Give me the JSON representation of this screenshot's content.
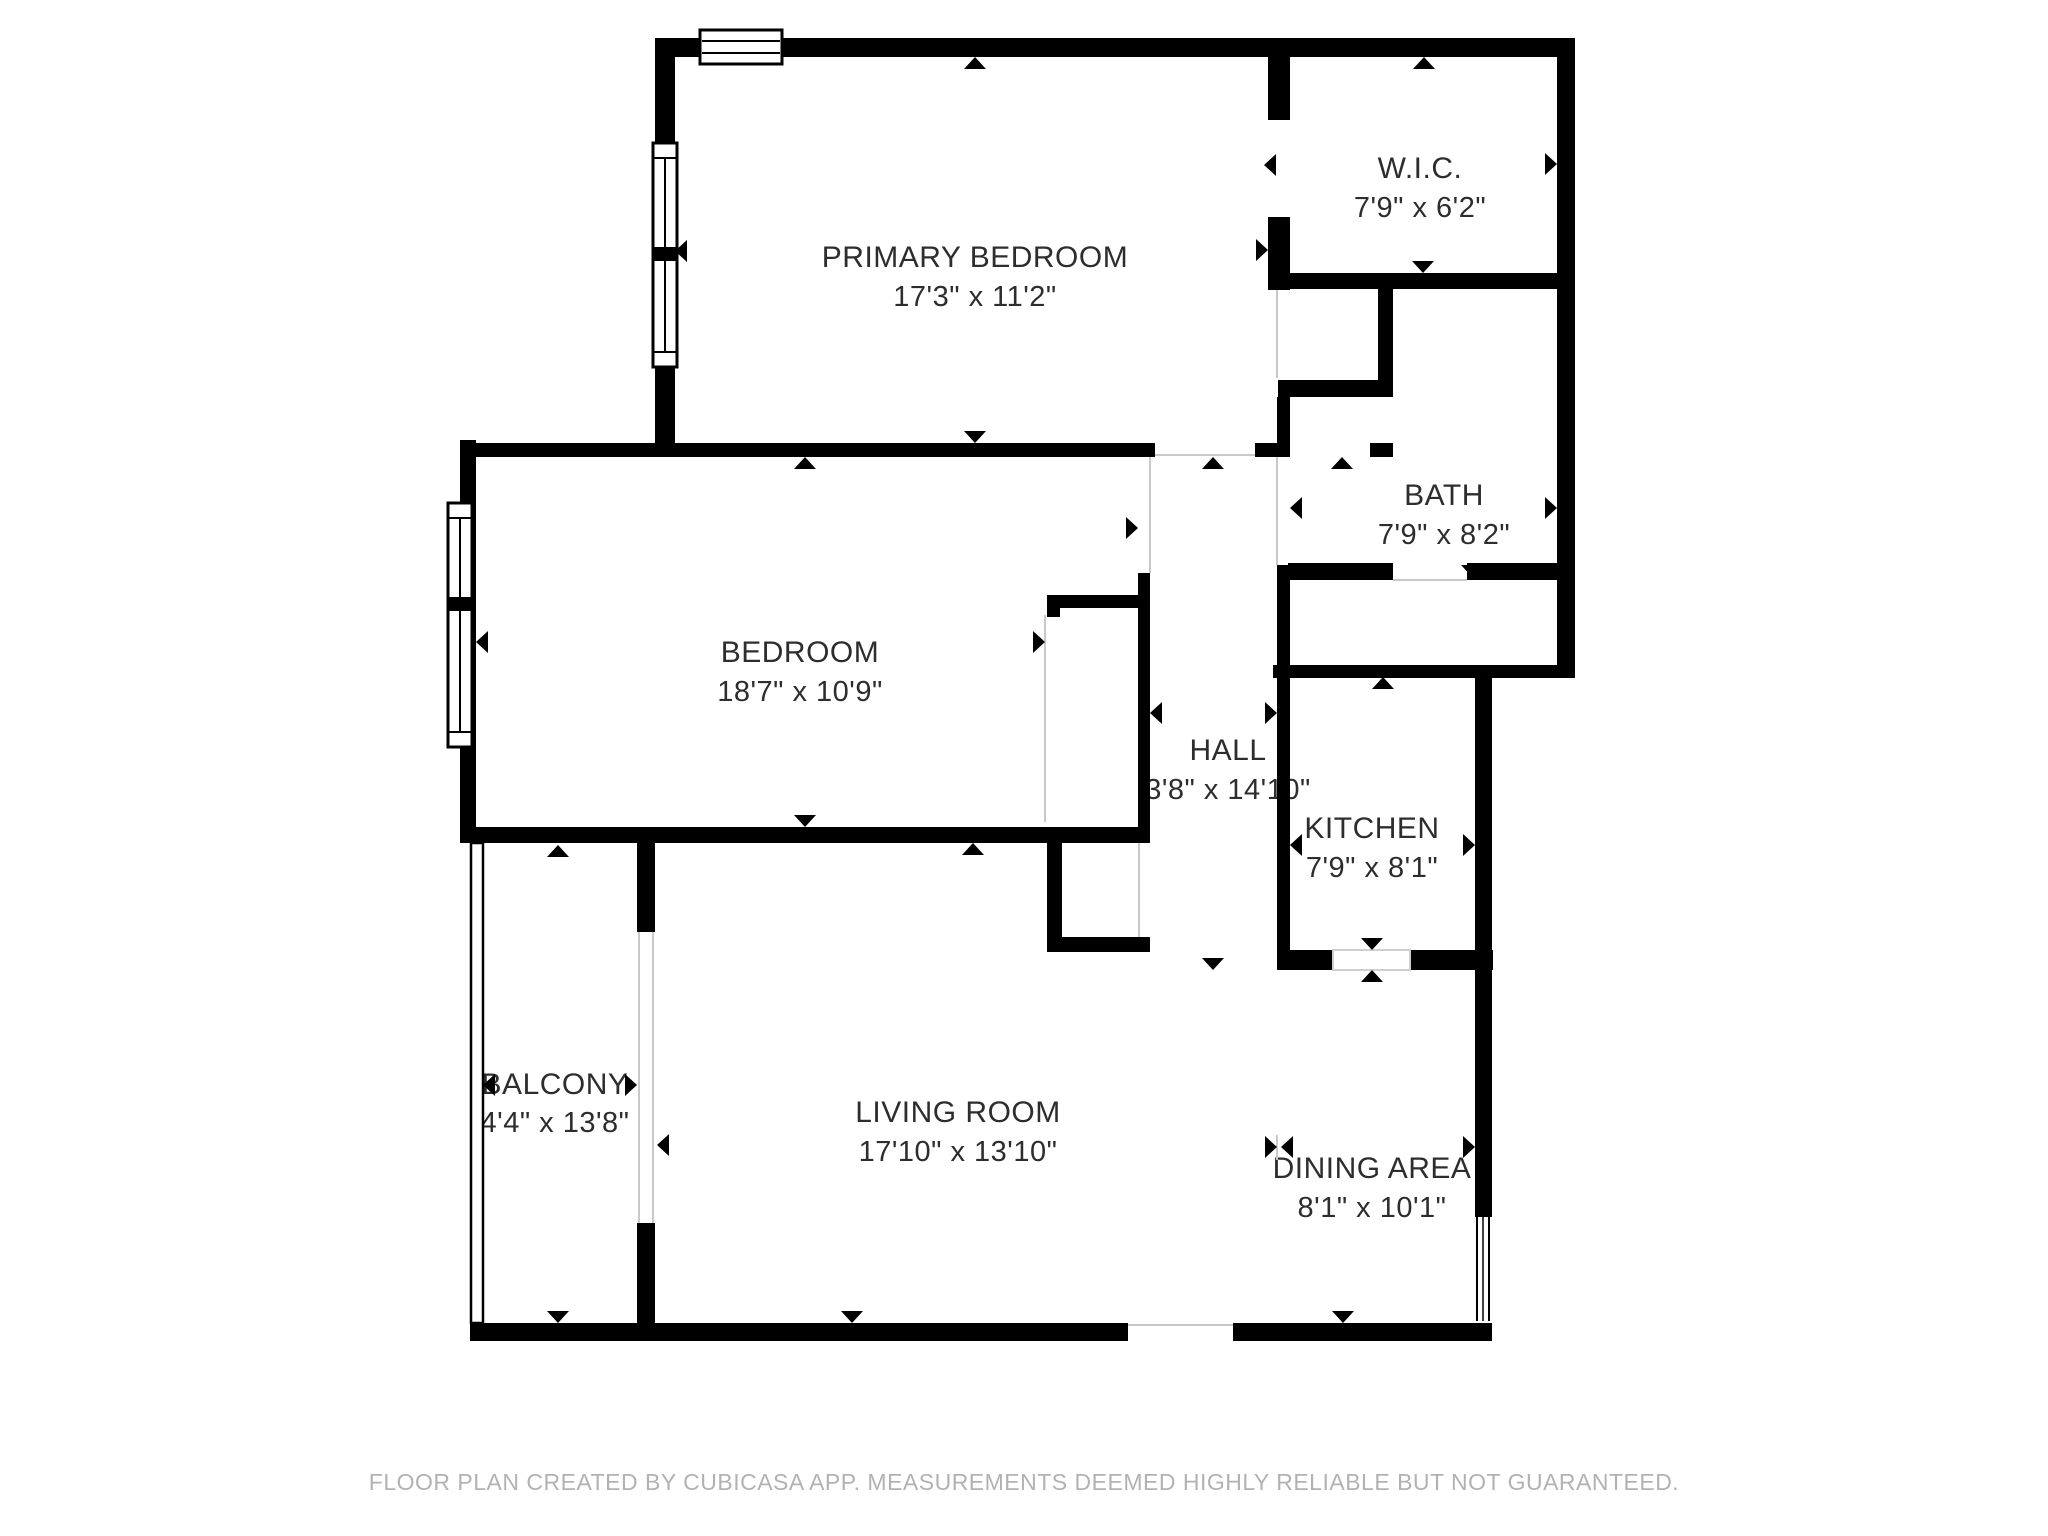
{
  "plan": {
    "title": "Apartment floor plan",
    "colors": {
      "wall": "#000000",
      "label": "#2d2d2d",
      "footer": "#b2b2b2",
      "background": "#ffffff",
      "open_boundary_line": "#c9c9c9"
    },
    "rooms": [
      {
        "id": "primary-bedroom",
        "name": "PRIMARY BEDROOM",
        "dims": "17'3\" x 11'2\""
      },
      {
        "id": "wic",
        "name": "W.I.C.",
        "dims": "7'9\" x 6'2\""
      },
      {
        "id": "bath",
        "name": "BATH",
        "dims": "7'9\" x 8'2\""
      },
      {
        "id": "bedroom",
        "name": "BEDROOM",
        "dims": "18'7\" x 10'9\""
      },
      {
        "id": "hall",
        "name": "HALL",
        "dims": "3'8\" x 14'10\""
      },
      {
        "id": "kitchen",
        "name": "KITCHEN",
        "dims": "7'9\" x 8'1\""
      },
      {
        "id": "balcony",
        "name": "BALCONY",
        "dims": "4'4\" x 13'8\""
      },
      {
        "id": "living-room",
        "name": "LIVING ROOM",
        "dims": "17'10\" x 13'10\""
      },
      {
        "id": "dining-area",
        "name": "DINING AREA",
        "dims": "8'1\" x 10'1\""
      }
    ],
    "footer": "FLOOR PLAN CREATED BY CUBICASA APP. MEASUREMENTS DEEMED HIGHLY RELIABLE BUT NOT GUARANTEED."
  }
}
